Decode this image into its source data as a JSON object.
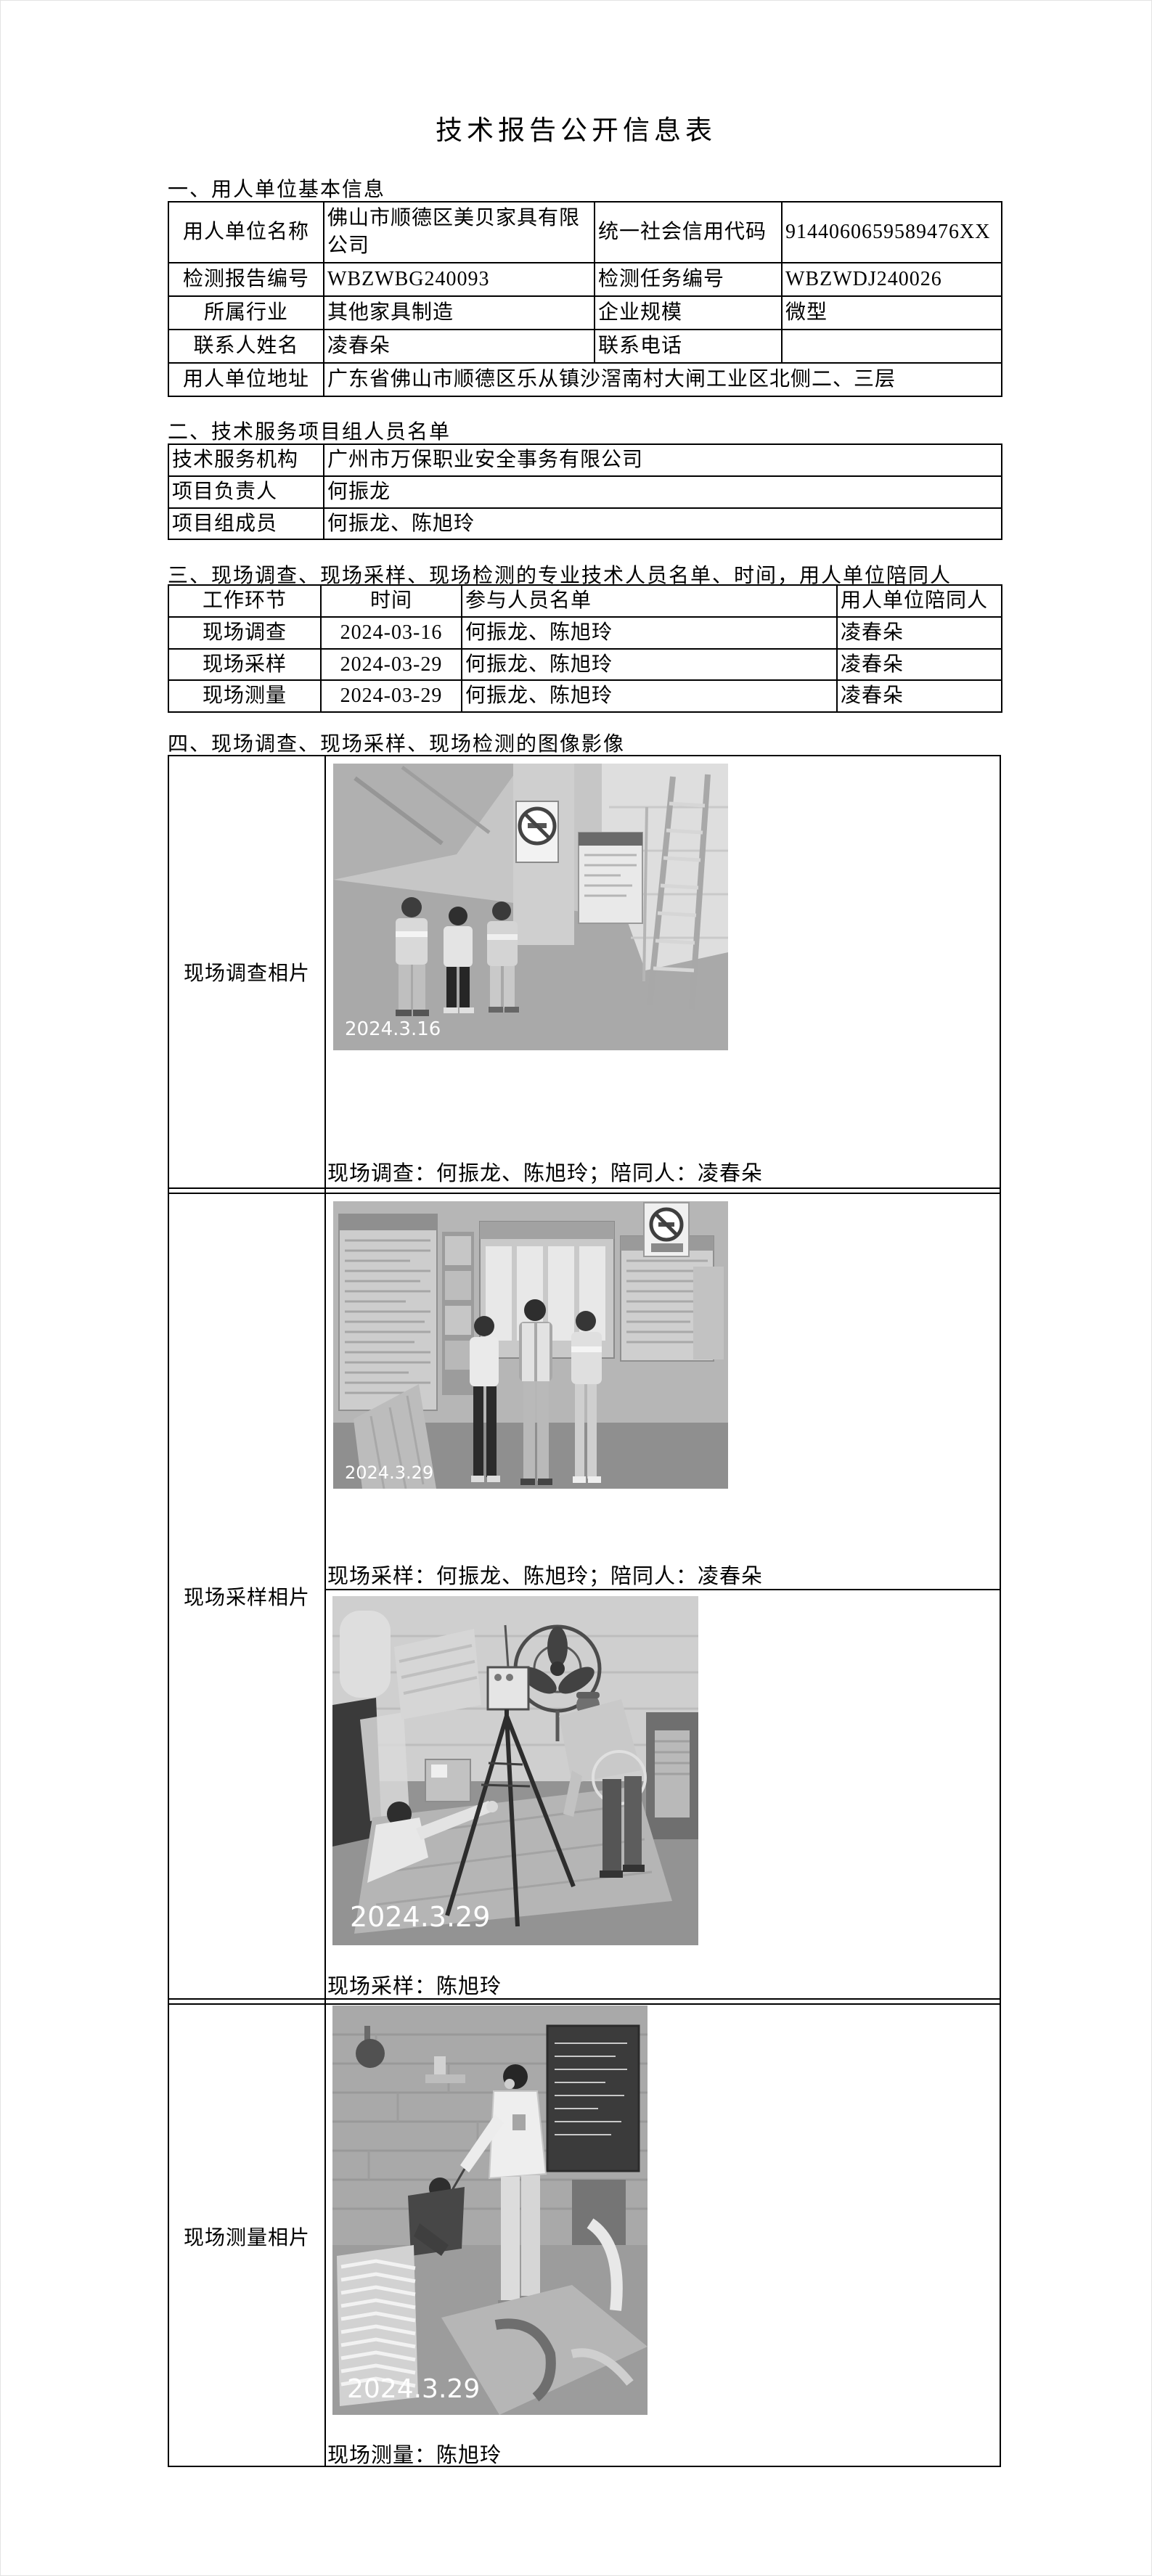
{
  "title": "技术报告公开信息表",
  "sections": {
    "one": "一、用人单位基本信息",
    "two": "二、技术服务项目组人员名单",
    "three": "三、现场调查、现场采样、现场检测的专业技术人员名单、时间，用人单位陪同人",
    "four": "四、现场调查、现场采样、现场检测的图像影像"
  },
  "basic_table": {
    "rows": [
      [
        "用人单位名称",
        "佛山市顺德区美贝家具有限公司",
        "统一社会信用代码",
        "9144060659589476XX"
      ],
      [
        "检测报告编号",
        "WBZWBG240093",
        "检测任务编号",
        "WBZWDJ240026"
      ],
      [
        "所属行业",
        "其他家具制造",
        "企业规模",
        "微型"
      ],
      [
        "联系人姓名",
        "凌春朵",
        "联系电话",
        ""
      ],
      [
        "用人单位地址",
        "广东省佛山市顺德区乐从镇沙滘南村大闸工业区北侧二、三层"
      ]
    ]
  },
  "team_table": {
    "rows": [
      [
        "技术服务机构",
        "广州市万保职业安全事务有限公司"
      ],
      [
        "项目负责人",
        "何振龙"
      ],
      [
        "项目组成员",
        "何振龙、陈旭玲"
      ]
    ]
  },
  "work_table": {
    "headers": [
      "工作环节",
      "时间",
      "参与人员名单",
      "用人单位陪同人"
    ],
    "rows": [
      [
        "现场调查",
        "2024-03-16",
        "何振龙、陈旭玲",
        "凌春朵"
      ],
      [
        "现场采样",
        "2024-03-29",
        "何振龙、陈旭玲",
        "凌春朵"
      ],
      [
        "现场测量",
        "2024-03-29",
        "何振龙、陈旭玲",
        "凌春朵"
      ]
    ]
  },
  "photos_table": {
    "rows": [
      {
        "label": "现场调查相片",
        "items": [
          {
            "date": "2024.3.16",
            "caption": "现场调查：何振龙、陈旭玲；陪同人：凌春朵"
          }
        ]
      },
      {
        "label": "现场采样相片",
        "items": [
          {
            "date": "2024.3.29",
            "caption": "现场采样：何振龙、陈旭玲；陪同人：凌春朵"
          },
          {
            "date": "2024.3.29",
            "caption": "现场采样：陈旭玲"
          }
        ]
      },
      {
        "label": "现场测量相片",
        "items": [
          {
            "date": "2024.3.29",
            "caption": "现场测量：陈旭玲"
          }
        ]
      }
    ]
  }
}
